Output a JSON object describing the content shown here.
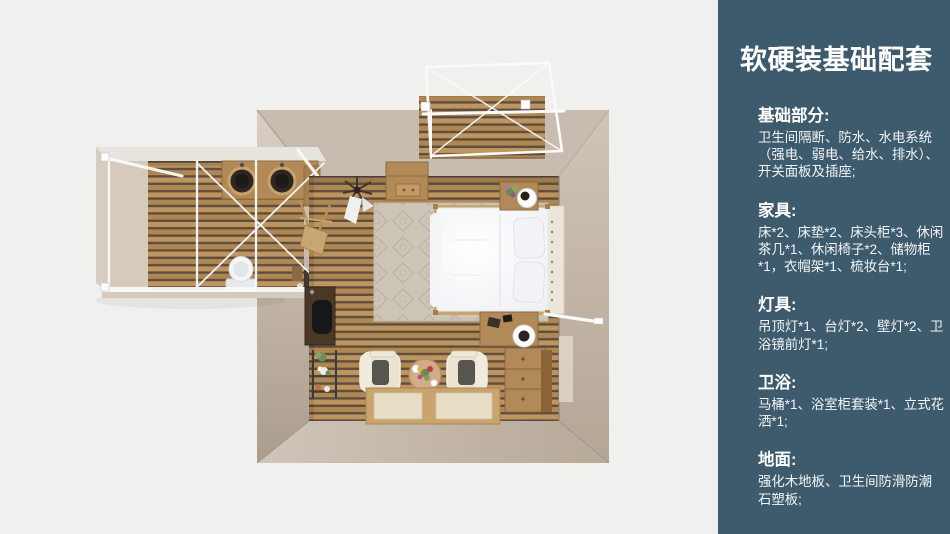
{
  "theme": {
    "canvas_bg": "#f0f0ee",
    "panel_bg": "#3d5b6c",
    "panel_text": "#ffffff",
    "floor_plank": "#bc8e52",
    "floor_gap": "#56504b",
    "wall_light": "#d7cdc1",
    "wall_mid": "#c8bcb0",
    "wall_dark": "#b0a294",
    "wood": "#b28a58",
    "frame_white": "#fafaf8",
    "bed_white": "#fbfcfd"
  },
  "panel": {
    "title": "软硬装基础配套",
    "sections": [
      {
        "heading": "基础部分:",
        "body": "卫生间隔断、防水、水电系统（强电、弱电、给水、排水）、开关面板及插座;"
      },
      {
        "heading": "家具:",
        "body": "床*2、床垫*2、床头柜*3、休闲茶几*1、休闲椅子*2、储物柜*1，衣帽架*1、梳妆台*1;"
      },
      {
        "heading": "灯具:",
        "body": "吊顶灯*1、台灯*2、壁灯*2、卫浴镜前灯*1;"
      },
      {
        "heading": "卫浴:",
        "body": "马桶*1、浴室柜套装*1、立式花洒*1;"
      },
      {
        "heading": "地面:",
        "body": "强化木地板、卫生间防滑防潮石塑板;"
      }
    ]
  },
  "floorplan": {
    "view": "顶视3D户型渲染图",
    "areas": [
      "卧室",
      "卫生间盥洗区",
      "入口露台"
    ],
    "visible_items": [
      "双人床",
      "地毯",
      "床头柜",
      "台灯",
      "储物柜",
      "梳妆台",
      "书桌",
      "休闲椅",
      "休闲茶几",
      "地垫",
      "衣帽架",
      "吊顶灯",
      "双盆浴室柜",
      "马桶",
      "白色钢架"
    ]
  }
}
